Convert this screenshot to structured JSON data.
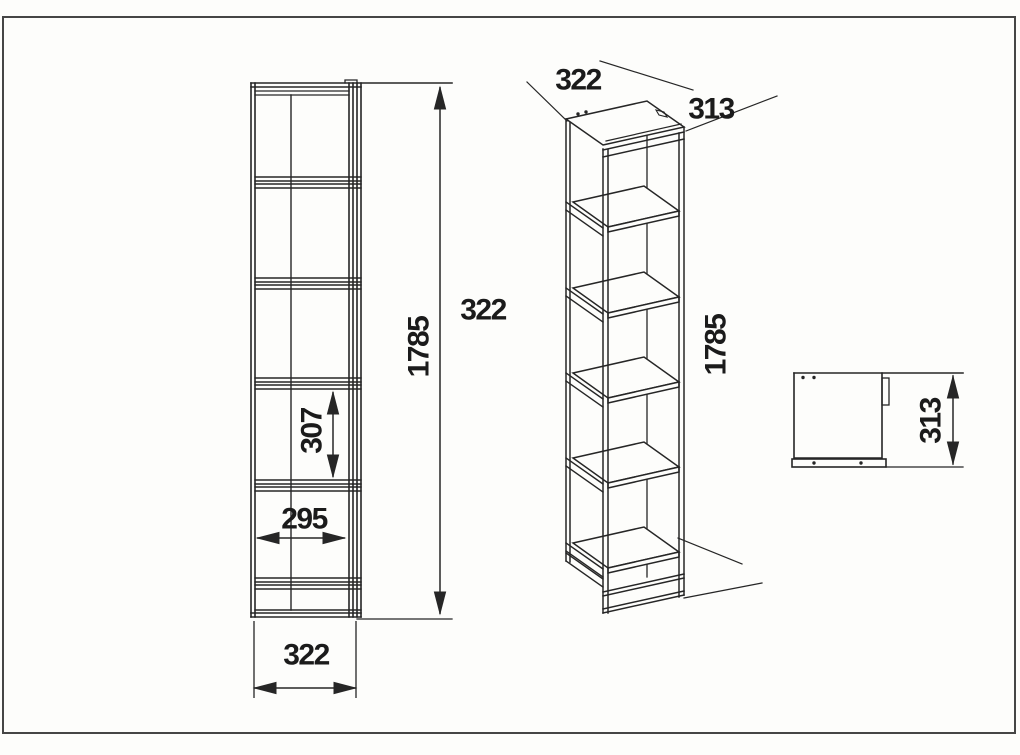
{
  "drawing": {
    "type": "furniture-technical-drawing",
    "subject": "tall narrow 5-shelf bookcase, three orthographic/axonometric views with dimensions (mm)",
    "views": {
      "front_view": {
        "dimensions": {
          "overall_height": "1785",
          "overall_width": "322",
          "inner_width": "295",
          "shelf_opening_height": "307",
          "panel_width": "322"
        }
      },
      "isometric_view": {
        "dimensions": {
          "width": "322",
          "depth": "313",
          "height": "1785"
        }
      },
      "side_view": {
        "dimensions": {
          "depth": "313"
        }
      }
    },
    "labels": [
      {
        "id": "front-height",
        "text": "1785"
      },
      {
        "id": "front-floating-width",
        "text": "322"
      },
      {
        "id": "front-opening",
        "text": "307"
      },
      {
        "id": "front-inner-width",
        "text": "295"
      },
      {
        "id": "front-bottom-width",
        "text": "322"
      },
      {
        "id": "iso-width",
        "text": "322"
      },
      {
        "id": "iso-depth",
        "text": "313"
      },
      {
        "id": "iso-height",
        "text": "1785"
      },
      {
        "id": "side-depth",
        "text": "313"
      }
    ],
    "colors": {
      "line": "#262626",
      "label": "#1b1b1b",
      "frame_border": "#454545",
      "background": "#fdfdfb",
      "shelf_fill": "#fdfdfb"
    }
  }
}
